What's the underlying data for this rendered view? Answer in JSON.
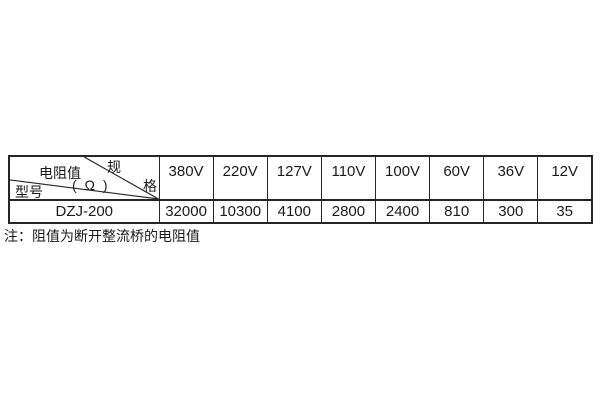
{
  "table": {
    "corner": {
      "spec_top": "规",
      "spec_bottom": "格",
      "resistance_label": "电阻值",
      "ohm_label": "( Ω )",
      "model_label": "型号"
    },
    "voltages": [
      "380V",
      "220V",
      "127V",
      "110V",
      "100V",
      "60V",
      "36V",
      "12V"
    ],
    "model": "DZJ-200",
    "values": [
      "32000",
      "10300",
      "4100",
      "2800",
      "2400",
      "810",
      "300",
      "35"
    ]
  },
  "note": "注：阻值为断开整流桥的电阻值",
  "colors": {
    "border": "#262626",
    "text": "#1a1a1a",
    "background": "#ffffff"
  }
}
